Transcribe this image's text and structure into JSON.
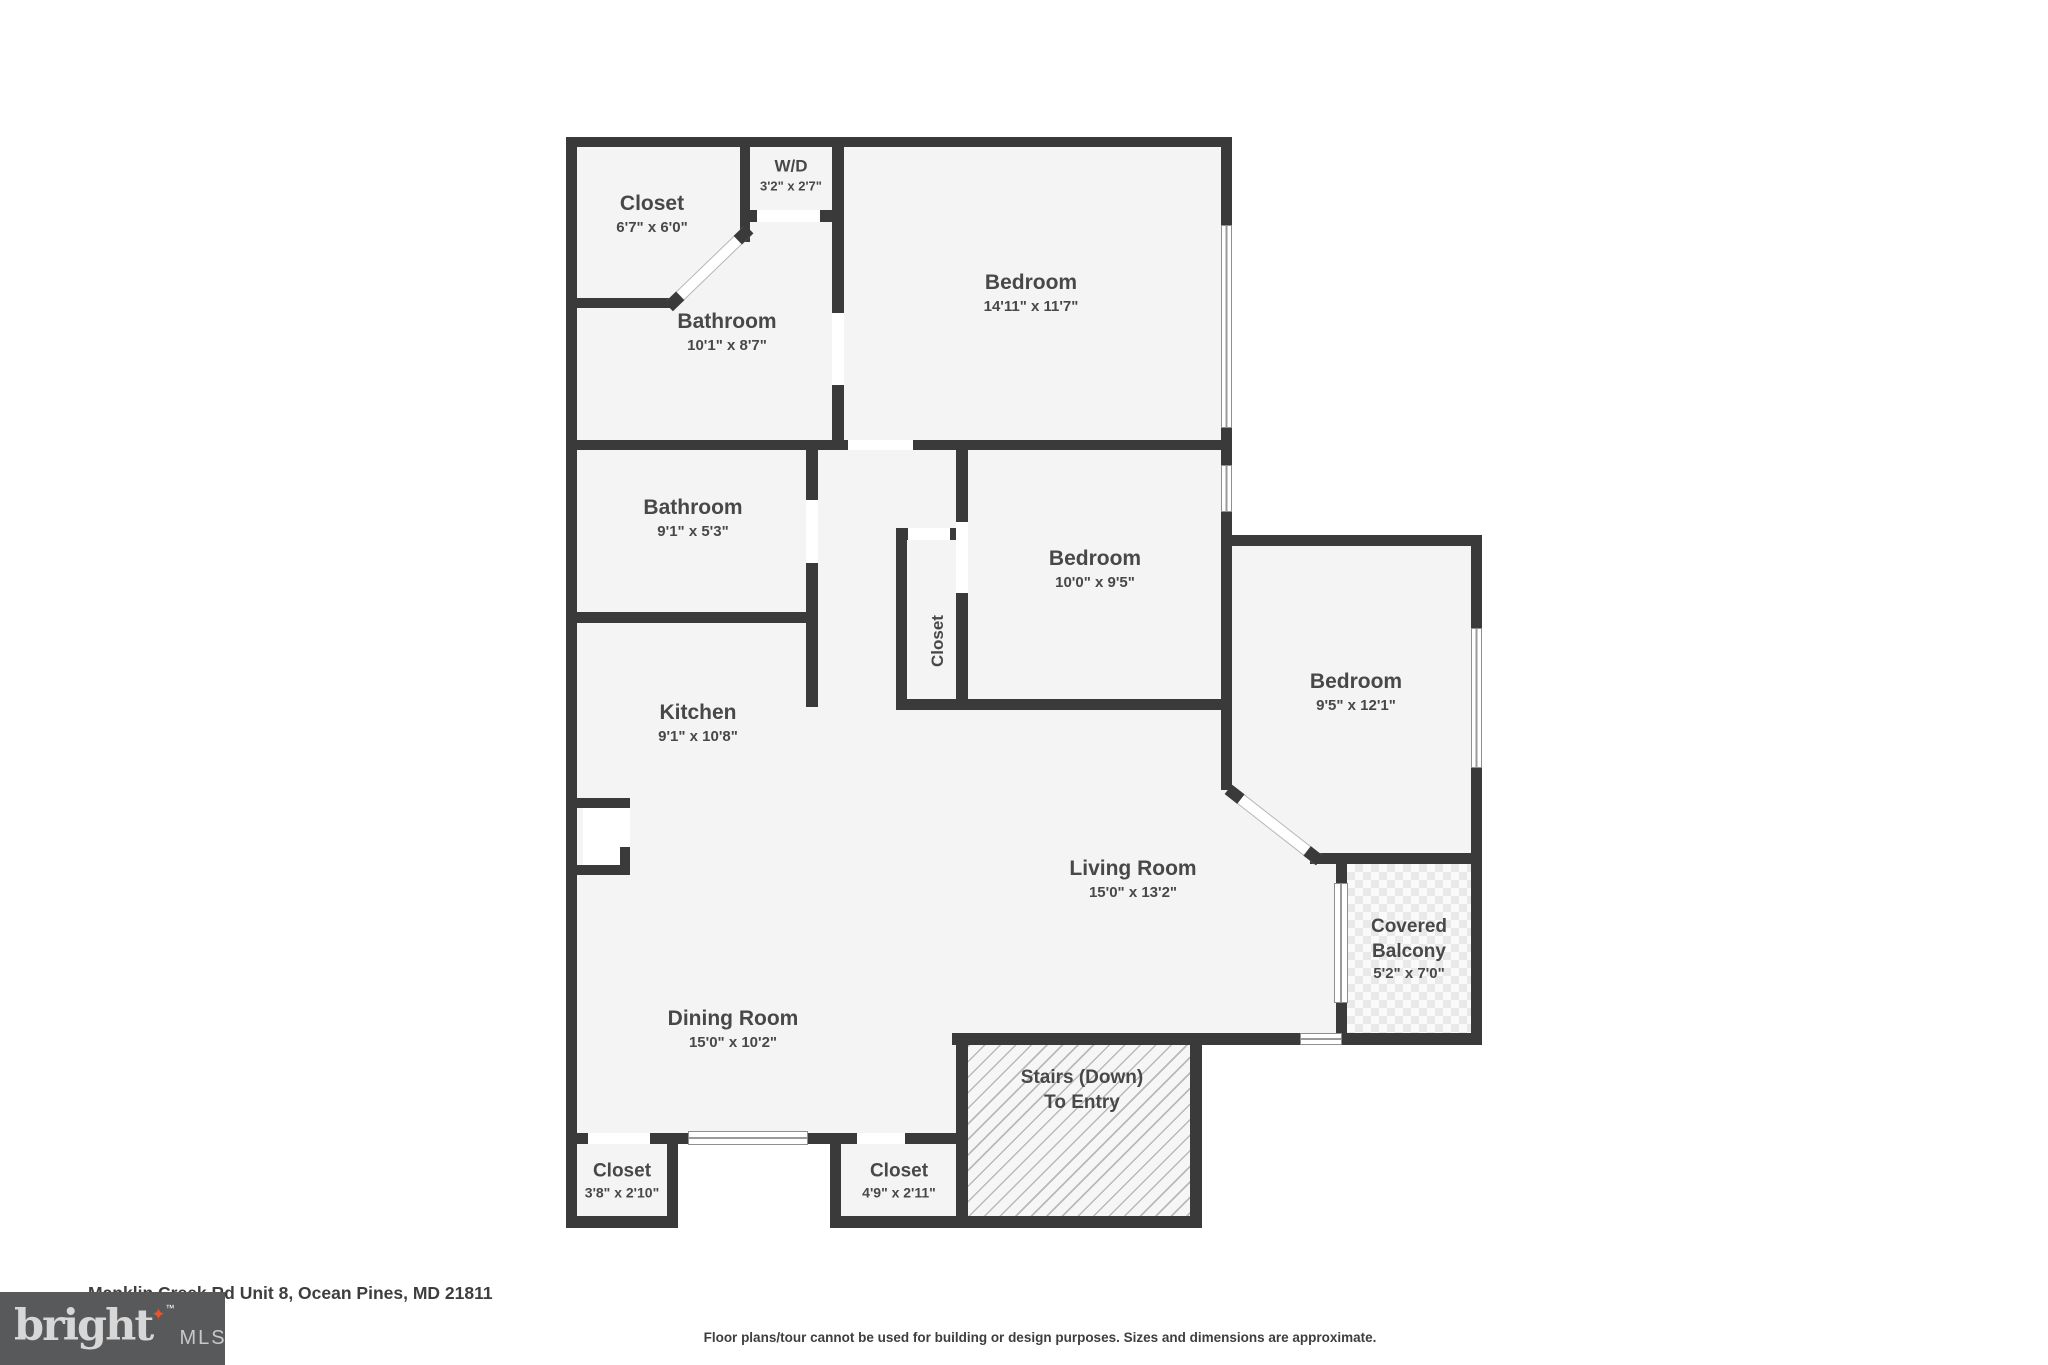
{
  "floorplan": {
    "rooms": [
      {
        "id": "closet-top-left",
        "lines": [
          "Closet",
          "6'7\" x 6'0\""
        ]
      },
      {
        "id": "washer-dryer",
        "lines": [
          "W/D",
          "3'2\" x 2'7\""
        ]
      },
      {
        "id": "bathroom-upper",
        "lines": [
          "Bathroom",
          "10'1\" x 8'7\""
        ]
      },
      {
        "id": "bedroom-upper",
        "lines": [
          "Bedroom",
          "14'11\" x 11'7\""
        ]
      },
      {
        "id": "bathroom-hall",
        "lines": [
          "Bathroom",
          "9'1\" x 5'3\""
        ]
      },
      {
        "id": "bedroom-middle",
        "lines": [
          "Bedroom",
          "10'0\" x 9'5\""
        ]
      },
      {
        "id": "hall-closet",
        "lines": [
          "Closet"
        ]
      },
      {
        "id": "bedroom-right",
        "lines": [
          "Bedroom",
          "9'5\" x 12'1\""
        ]
      },
      {
        "id": "kitchen",
        "lines": [
          "Kitchen",
          "9'1\" x 10'8\""
        ]
      },
      {
        "id": "living-room",
        "lines": [
          "Living Room",
          "15'0\" x 13'2\""
        ]
      },
      {
        "id": "dining-room",
        "lines": [
          "Dining Room",
          "15'0\" x 10'2\""
        ]
      },
      {
        "id": "covered-balcony",
        "lines": [
          "Covered",
          "Balcony",
          "5'2\" x 7'0\""
        ]
      },
      {
        "id": "stairs",
        "lines": [
          "Stairs (Down)",
          "To Entry"
        ]
      },
      {
        "id": "closet-bottom-left",
        "lines": [
          "Closet",
          "3'8\" x 2'10\""
        ]
      },
      {
        "id": "closet-bottom-right",
        "lines": [
          "Closet",
          "4'9\" x 2'11\""
        ]
      }
    ]
  },
  "footer": {
    "address": "Manklin Creek Rd Unit 8, Ocean Pines, MD 21811",
    "disclaimer": "Floor plans/tour cannot be used for building or design purposes. Sizes and dimensions are approximate.",
    "logo": {
      "brand": "bright",
      "suffix": "MLS",
      "star_icon": "✦",
      "trademark": "™"
    }
  },
  "colors": {
    "wall": "#3a3a3a",
    "room_fill": "#f4f4f4",
    "label_text": "#484848",
    "logo_background": "#58595b",
    "logo_star": "#e8542c"
  }
}
